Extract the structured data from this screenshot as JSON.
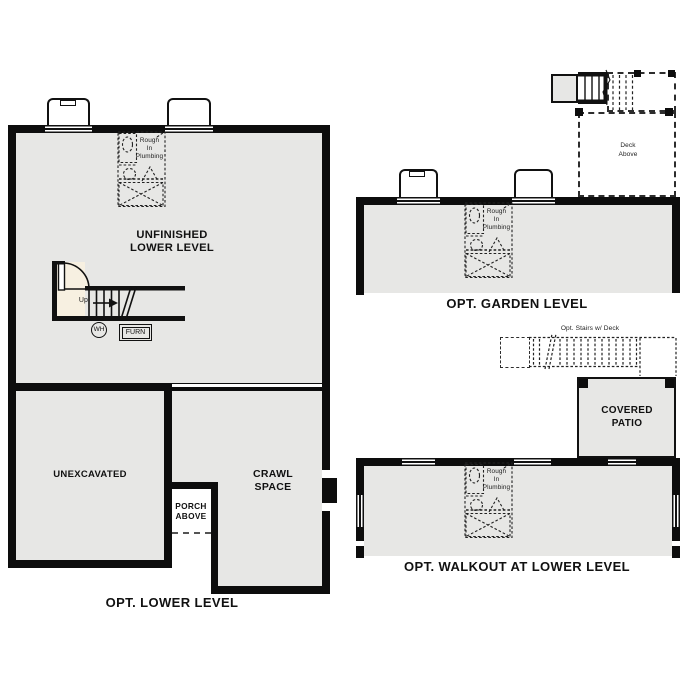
{
  "lower_level": {
    "title": "OPT. LOWER LEVEL",
    "unfinished_label": "UNFINISHED\nLOWER LEVEL",
    "unexcavated_label": "UNEXCAVATED",
    "crawl_label": "CRAWL\nSPACE",
    "porch_label": "PORCH\nABOVE",
    "stairs_up_label": "Up",
    "water_heater_label": "WH",
    "furnace_label": "FURN",
    "plumbing_label": "Rough\nIn\nPlumbing"
  },
  "garden_level": {
    "title": "OPT. GARDEN LEVEL",
    "deck_label": "Deck\nAbove",
    "plumbing_label": "Rough\nIn\nPlumbing"
  },
  "walkout_level": {
    "title": "OPT. WALKOUT AT LOWER LEVEL",
    "stairs_label": "Opt. Stairs w/ Deck",
    "patio_label": "COVERED\nPATIO",
    "plumbing_label": "Rough\nIn\nPlumbing"
  },
  "colors": {
    "floor_fill": "#e7e7e5",
    "wall": "#0d0d0d",
    "stair_alcove_fill": "#f7f0e1",
    "linework": "#222222"
  }
}
